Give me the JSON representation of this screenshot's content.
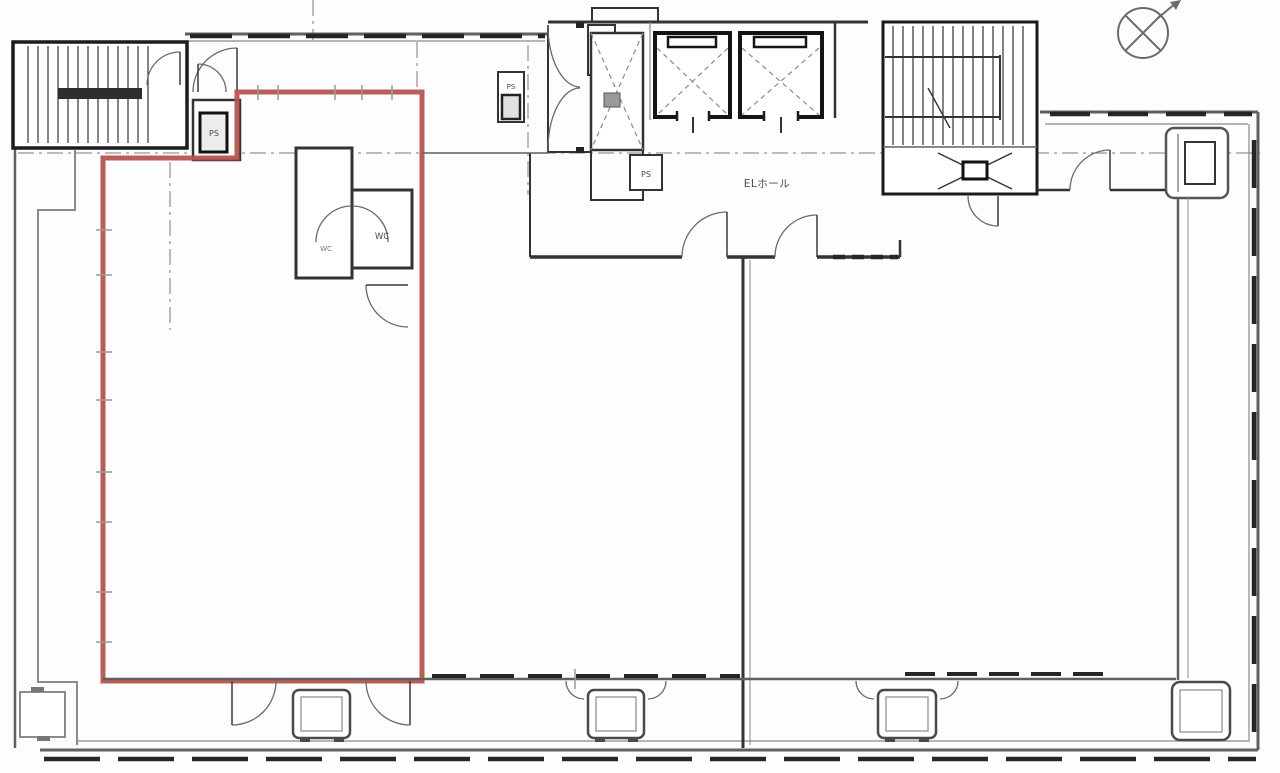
{
  "document": {
    "type": "architectural-floor-plan",
    "description": "Scanned office building floor plan with one vacant unit outlined in red"
  },
  "labels": {
    "elevator_hall": "ELホール",
    "wc_a": "WC",
    "wc_b": "WC",
    "ps_entry": "PS",
    "ps_corridor": "PS",
    "ps_core": "PS"
  },
  "colors": {
    "highlight_red": "#b5504b",
    "wall_dark": "#1c1c1c",
    "wall_gray": "#5f5f5f",
    "paper": "#fdfdfd"
  },
  "highlighted_unit": {
    "points": "237,92 422,92 422,681 103,681 103,158 237,158"
  },
  "symbols": {
    "north_arrow": "compass circle with diagonal cross and arrow",
    "elevators": 2,
    "stairwells": 2
  }
}
